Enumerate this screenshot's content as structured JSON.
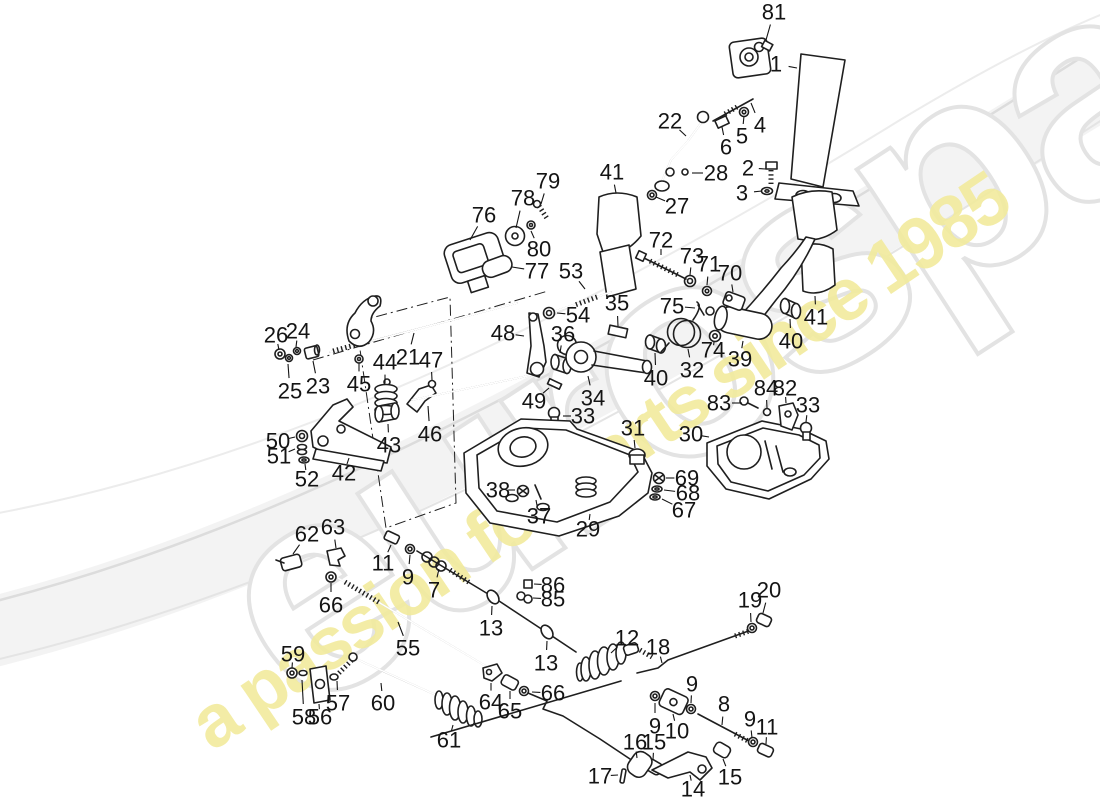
{
  "watermark": {
    "brand": "eurospares",
    "tagline": "a passion for parts since 1985",
    "brand_fill": "#ffffff",
    "brand_stroke": "#e3e3e3",
    "tagline_color": "#f2eb9d",
    "swoosh_color": "#e0e0e0",
    "angle_deg": -33
  },
  "diagram": {
    "ink": "#1f1f1f",
    "background": "#ffffff",
    "labels": [
      {
        "n": "81",
        "x": 774,
        "y": 12,
        "lx": 766,
        "ly": 40
      },
      {
        "n": "1",
        "x": 776,
        "y": 64,
        "lx": 797,
        "ly": 68
      },
      {
        "n": "4",
        "x": 760,
        "y": 125,
        "lx": 751,
        "ly": 103
      },
      {
        "n": "5",
        "x": 742,
        "y": 136,
        "lx": 744,
        "ly": 116
      },
      {
        "n": "6",
        "x": 726,
        "y": 147,
        "lx": 722,
        "ly": 127
      },
      {
        "n": "2",
        "x": 748,
        "y": 168,
        "lx": 766,
        "ly": 169
      },
      {
        "n": "3",
        "x": 742,
        "y": 193,
        "lx": 762,
        "ly": 191
      },
      {
        "n": "28",
        "x": 716,
        "y": 173,
        "lx": 692,
        "ly": 173
      },
      {
        "n": "27",
        "x": 677,
        "y": 206,
        "lx": 656,
        "ly": 197
      },
      {
        "n": "22",
        "x": 670,
        "y": 121,
        "lx": 686,
        "ly": 136
      },
      {
        "n": "41",
        "x": 612,
        "y": 172,
        "lx": 616,
        "ly": 193
      },
      {
        "n": "76",
        "x": 484,
        "y": 215,
        "lx": 470,
        "ly": 240
      },
      {
        "n": "78",
        "x": 523,
        "y": 198,
        "lx": 516,
        "ly": 228
      },
      {
        "n": "79",
        "x": 548,
        "y": 181,
        "lx": 541,
        "ly": 204
      },
      {
        "n": "80",
        "x": 539,
        "y": 249,
        "lx": 531,
        "ly": 231
      },
      {
        "n": "77",
        "x": 537,
        "y": 271,
        "lx": 512,
        "ly": 267
      },
      {
        "n": "53",
        "x": 571,
        "y": 271,
        "lx": 585,
        "ly": 289
      },
      {
        "n": "54",
        "x": 578,
        "y": 315,
        "lx": 557,
        "ly": 313
      },
      {
        "n": "35",
        "x": 617,
        "y": 303,
        "lx": 618,
        "ly": 326
      },
      {
        "n": "36",
        "x": 563,
        "y": 334,
        "lx": 560,
        "ly": 353
      },
      {
        "n": "21",
        "x": 408,
        "y": 357,
        "lx": 414,
        "ly": 333
      },
      {
        "n": "47",
        "x": 431,
        "y": 360,
        "lx": 432,
        "ly": 380
      },
      {
        "n": "44",
        "x": 385,
        "y": 362,
        "lx": 385,
        "ly": 383
      },
      {
        "n": "45",
        "x": 359,
        "y": 384,
        "lx": 359,
        "ly": 363
      },
      {
        "n": "26",
        "x": 276,
        "y": 335,
        "lx": 279,
        "ly": 350
      },
      {
        "n": "24",
        "x": 298,
        "y": 331,
        "lx": 296,
        "ly": 347
      },
      {
        "n": "25",
        "x": 290,
        "y": 391,
        "lx": 288,
        "ly": 364
      },
      {
        "n": "23",
        "x": 318,
        "y": 386,
        "lx": 313,
        "ly": 361
      },
      {
        "n": "48",
        "x": 503,
        "y": 333,
        "lx": 524,
        "ly": 336
      },
      {
        "n": "49",
        "x": 534,
        "y": 401,
        "lx": 549,
        "ly": 388
      },
      {
        "n": "46",
        "x": 430,
        "y": 434,
        "lx": 428,
        "ly": 406
      },
      {
        "n": "43",
        "x": 389,
        "y": 445,
        "lx": 388,
        "ly": 424
      },
      {
        "n": "42",
        "x": 344,
        "y": 473,
        "lx": 349,
        "ly": 458
      },
      {
        "n": "50",
        "x": 278,
        "y": 441,
        "lx": 295,
        "ly": 437
      },
      {
        "n": "51",
        "x": 279,
        "y": 456,
        "lx": 295,
        "ly": 449
      },
      {
        "n": "52",
        "x": 307,
        "y": 479,
        "lx": 305,
        "ly": 464
      },
      {
        "n": "62",
        "x": 307,
        "y": 534,
        "lx": 293,
        "ly": 554
      },
      {
        "n": "63",
        "x": 333,
        "y": 527,
        "lx": 336,
        "ly": 548
      },
      {
        "n": "66",
        "x": 331,
        "y": 605,
        "lx": 331,
        "ly": 583
      },
      {
        "n": "11",
        "x": 383,
        "y": 563,
        "lx": 391,
        "ly": 545
      },
      {
        "n": "9",
        "x": 408,
        "y": 577,
        "lx": 410,
        "ly": 555
      },
      {
        "n": "7",
        "x": 434,
        "y": 590,
        "lx": 439,
        "ly": 569
      },
      {
        "n": "55",
        "x": 408,
        "y": 648,
        "lx": 398,
        "ly": 622
      },
      {
        "n": "86",
        "x": 553,
        "y": 585,
        "lx": 534,
        "ly": 584
      },
      {
        "n": "85",
        "x": 553,
        "y": 599,
        "lx": 533,
        "ly": 598
      },
      {
        "n": "13",
        "x": 491,
        "y": 628,
        "lx": 492,
        "ly": 606
      },
      {
        "n": "13",
        "x": 546,
        "y": 663,
        "lx": 547,
        "ly": 641
      },
      {
        "n": "59",
        "x": 293,
        "y": 654,
        "lx": 292,
        "ly": 668
      },
      {
        "n": "58",
        "x": 304,
        "y": 717,
        "lx": 302,
        "ly": 680
      },
      {
        "n": "56",
        "x": 320,
        "y": 717,
        "lx": 319,
        "ly": 704
      },
      {
        "n": "57",
        "x": 338,
        "y": 703,
        "lx": 337,
        "ly": 681
      },
      {
        "n": "60",
        "x": 383,
        "y": 703,
        "lx": 381,
        "ly": 683
      },
      {
        "n": "61",
        "x": 449,
        "y": 740,
        "lx": 453,
        "ly": 725
      },
      {
        "n": "64",
        "x": 491,
        "y": 702,
        "lx": 491,
        "ly": 683
      },
      {
        "n": "65",
        "x": 510,
        "y": 711,
        "lx": 510,
        "ly": 691
      },
      {
        "n": "66",
        "x": 553,
        "y": 693,
        "lx": 532,
        "ly": 692
      },
      {
        "n": "12",
        "x": 627,
        "y": 638,
        "lx": 611,
        "ly": 653
      },
      {
        "n": "18",
        "x": 658,
        "y": 647,
        "lx": 662,
        "ly": 663
      },
      {
        "n": "19",
        "x": 750,
        "y": 600,
        "lx": 751,
        "ly": 622
      },
      {
        "n": "20",
        "x": 769,
        "y": 590,
        "lx": 763,
        "ly": 613
      },
      {
        "n": "9",
        "x": 692,
        "y": 684,
        "lx": 691,
        "ly": 703
      },
      {
        "n": "9",
        "x": 655,
        "y": 726,
        "lx": 655,
        "ly": 703
      },
      {
        "n": "10",
        "x": 677,
        "y": 731,
        "lx": 673,
        "ly": 714
      },
      {
        "n": "8",
        "x": 724,
        "y": 704,
        "lx": 722,
        "ly": 725
      },
      {
        "n": "9",
        "x": 750,
        "y": 719,
        "lx": 752,
        "ly": 738
      },
      {
        "n": "11",
        "x": 767,
        "y": 727,
        "lx": 766,
        "ly": 744
      },
      {
        "n": "16",
        "x": 635,
        "y": 742,
        "lx": 637,
        "ly": 758
      },
      {
        "n": "15",
        "x": 654,
        "y": 742,
        "lx": 653,
        "ly": 760
      },
      {
        "n": "17",
        "x": 600,
        "y": 776,
        "lx": 618,
        "ly": 775
      },
      {
        "n": "14",
        "x": 693,
        "y": 789,
        "lx": 690,
        "ly": 775
      },
      {
        "n": "15",
        "x": 730,
        "y": 777,
        "lx": 723,
        "ly": 759
      },
      {
        "n": "29",
        "x": 588,
        "y": 529,
        "lx": 590,
        "ly": 514
      },
      {
        "n": "37",
        "x": 539,
        "y": 516,
        "lx": 536,
        "ly": 500
      },
      {
        "n": "38",
        "x": 498,
        "y": 490,
        "lx": 515,
        "ly": 490
      },
      {
        "n": "31",
        "x": 633,
        "y": 428,
        "lx": 635,
        "ly": 448
      },
      {
        "n": "33",
        "x": 583,
        "y": 416,
        "lx": 563,
        "ly": 416
      },
      {
        "n": "30",
        "x": 691,
        "y": 434,
        "lx": 709,
        "ly": 437
      },
      {
        "n": "69",
        "x": 687,
        "y": 478,
        "lx": 666,
        "ly": 478
      },
      {
        "n": "68",
        "x": 688,
        "y": 493,
        "lx": 664,
        "ly": 490
      },
      {
        "n": "67",
        "x": 684,
        "y": 510,
        "lx": 662,
        "ly": 499
      },
      {
        "n": "83",
        "x": 719,
        "y": 403,
        "lx": 742,
        "ly": 403
      },
      {
        "n": "84",
        "x": 766,
        "y": 388,
        "lx": 767,
        "ly": 408
      },
      {
        "n": "82",
        "x": 785,
        "y": 388,
        "lx": 786,
        "ly": 403
      },
      {
        "n": "33",
        "x": 808,
        "y": 405,
        "lx": 806,
        "ly": 422
      },
      {
        "n": "32",
        "x": 692,
        "y": 370,
        "lx": 688,
        "ly": 349
      },
      {
        "n": "34",
        "x": 593,
        "y": 398,
        "lx": 588,
        "ly": 376
      },
      {
        "n": "40",
        "x": 656,
        "y": 378,
        "lx": 655,
        "ly": 353
      },
      {
        "n": "39",
        "x": 740,
        "y": 359,
        "lx": 743,
        "ly": 341
      },
      {
        "n": "74",
        "x": 713,
        "y": 350,
        "lx": 714,
        "ly": 342
      },
      {
        "n": "75",
        "x": 672,
        "y": 306,
        "lx": 695,
        "ly": 308
      },
      {
        "n": "70",
        "x": 730,
        "y": 273,
        "lx": 733,
        "ly": 292
      },
      {
        "n": "71",
        "x": 709,
        "y": 264,
        "lx": 707,
        "ly": 285
      },
      {
        "n": "73",
        "x": 692,
        "y": 256,
        "lx": 690,
        "ly": 275
      },
      {
        "n": "72",
        "x": 661,
        "y": 240,
        "lx": 661,
        "ly": 255
      },
      {
        "n": "40",
        "x": 791,
        "y": 341,
        "lx": 790,
        "ly": 319
      },
      {
        "n": "41",
        "x": 816,
        "y": 317,
        "lx": 815,
        "ly": 296
      }
    ]
  }
}
